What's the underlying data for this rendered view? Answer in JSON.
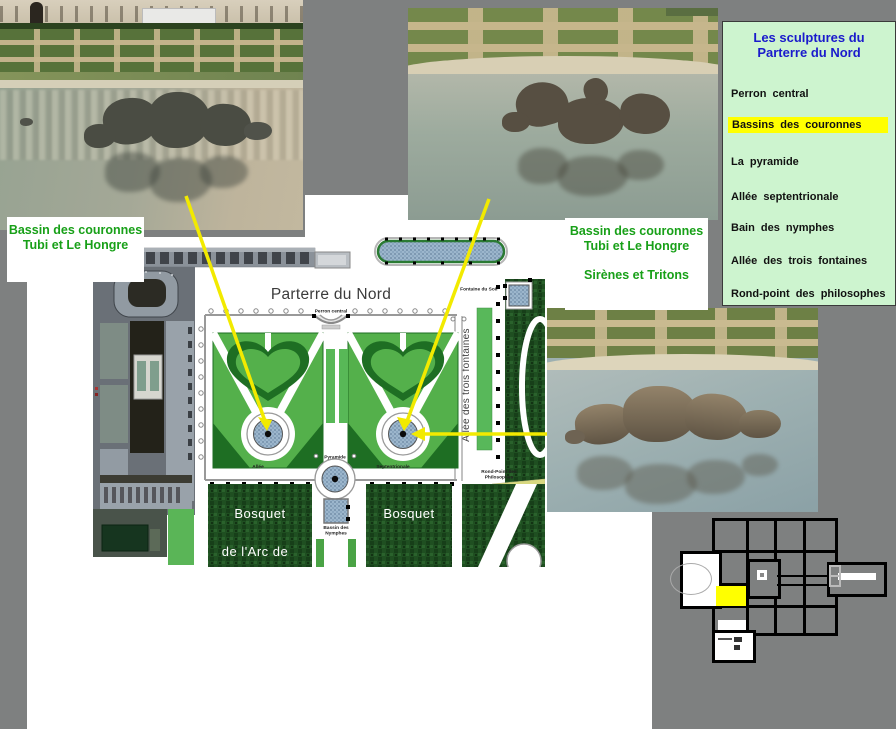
{
  "page": {
    "background": "#7e8080",
    "slide_background": "#ffffff",
    "accent_line_color": "#f2ea00"
  },
  "menu_panel": {
    "title": "Les sculptures du Parterre du Nord",
    "title_color": "#1a1acc",
    "background": "#cdf4cf",
    "highlight_color": "#ffff00",
    "items": [
      {
        "label": "Perron central",
        "highlighted": false
      },
      {
        "label": "Bassins des couronnes",
        "highlighted": true
      },
      {
        "label": "La pyramide",
        "highlighted": false
      },
      {
        "label": "Allée septentrionale",
        "highlighted": false
      },
      {
        "label": "Bain des nymphes",
        "highlighted": false
      },
      {
        "label": "Allée des trois fontaines",
        "highlighted": false
      },
      {
        "label": "Rond-point des philosophes",
        "highlighted": false
      }
    ]
  },
  "callouts": {
    "text_color": "#18a018",
    "left": {
      "line1": "Bassin des couronnes",
      "line2": "Tubi et Le Hongre"
    },
    "right": {
      "line1": "Bassin des couronnes",
      "line2": "Tubi et Le Hongre",
      "line3": "Sirènes et Tritons"
    }
  },
  "map": {
    "title": "Parterre du Nord",
    "labels": {
      "perron": "Perron central",
      "fontaine_du_soir": "Fontaine du Soir",
      "allee": "Allée",
      "pyramide": "Pyramide",
      "septentrionale": "Septentrionale",
      "trois_fontaines": "Allée des trois fontaines",
      "rond_point_1": "Rond-Point des",
      "rond_point_2": "Philosophes",
      "nymphes_1": "Bassin des",
      "nymphes_2": "Nymphes",
      "bosquet_left": "Bosquet",
      "bosquet_right": "Bosquet",
      "arc": "de l'Arc de"
    }
  },
  "minimap": {
    "highlight_color": "#ffff00"
  }
}
